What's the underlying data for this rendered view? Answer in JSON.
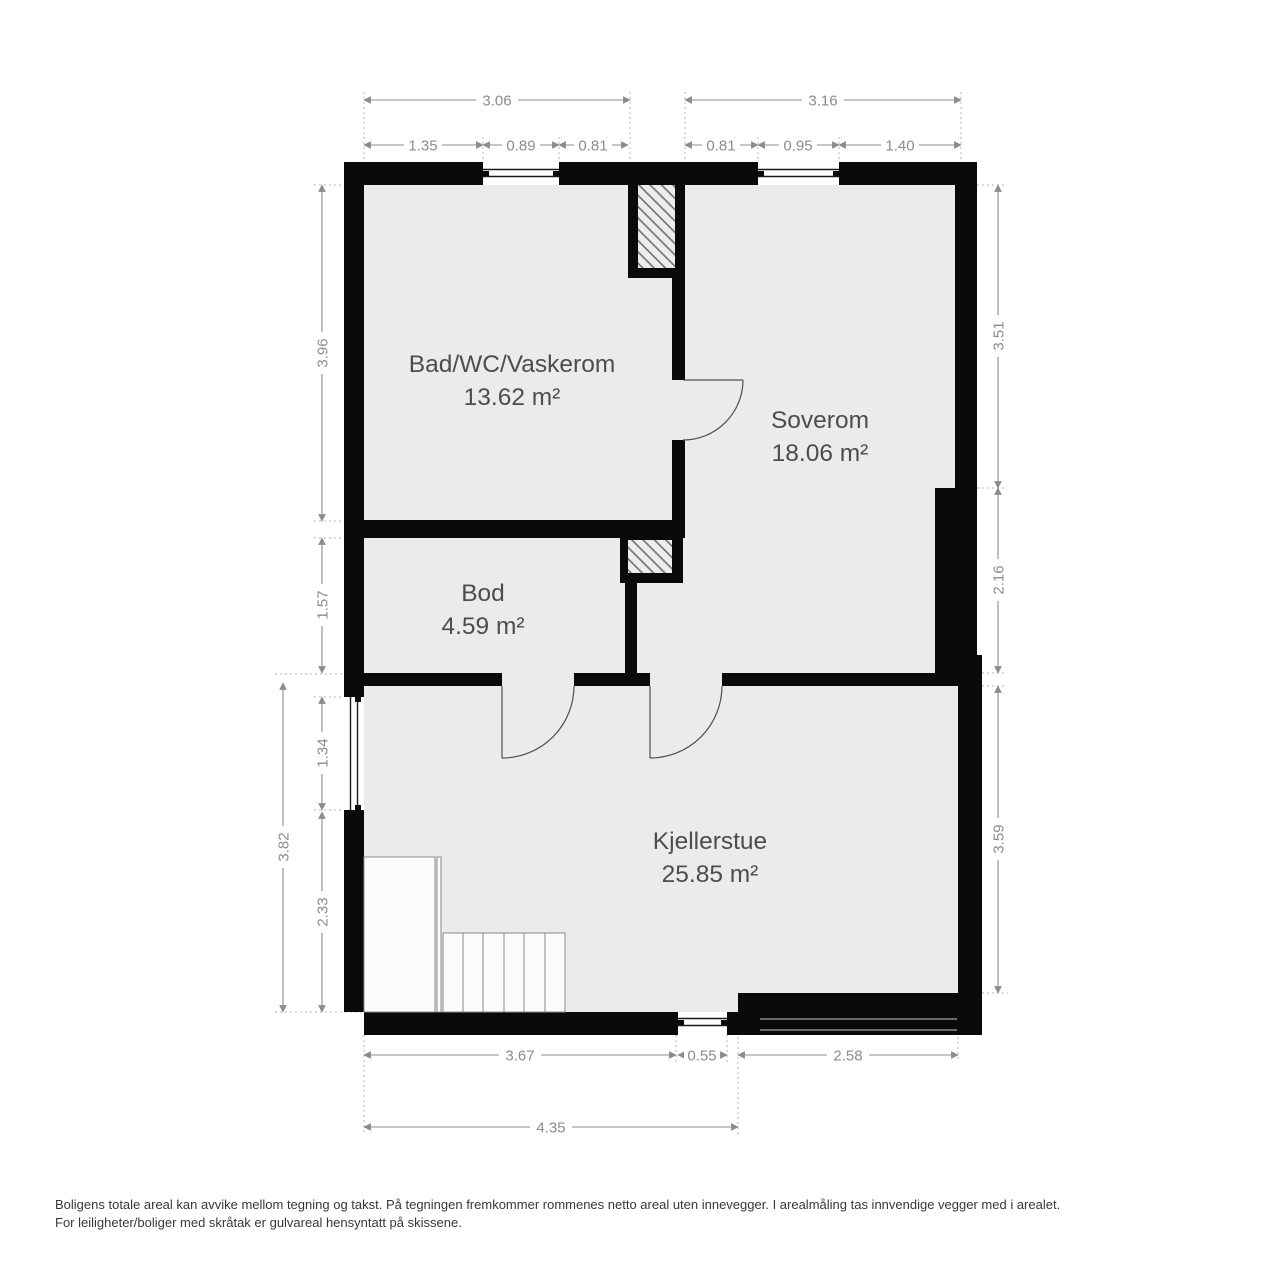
{
  "rooms": {
    "bad": {
      "name": "Bad/WC/Vaskerom",
      "area": "13.62 m²"
    },
    "soverom": {
      "name": "Soverom",
      "area": "18.06 m²"
    },
    "bod": {
      "name": "Bod",
      "area": "4.59 m²"
    },
    "kjellerstue": {
      "name": "Kjellerstue",
      "area": "25.85 m²"
    }
  },
  "dims": {
    "top_overall_left": "3.06",
    "top_overall_right": "3.16",
    "top_sub": [
      "1.35",
      "0.89",
      "0.81",
      "0.81",
      "0.95",
      "1.40"
    ],
    "left_bad": "3.96",
    "left_bod": "1.57",
    "left_overall": "3.82",
    "left_window": "1.34",
    "left_lower": "2.33",
    "right_upper": "3.51",
    "right_mid": "2.16",
    "right_lower": "3.59",
    "bottom_left": "3.67",
    "bottom_window": "0.55",
    "bottom_right": "2.58",
    "bottom_overall": "4.35"
  },
  "footer": {
    "line1": "Boligens totale areal kan avvike mellom tegning og takst. På tegningen fremkommer rommenes netto areal uten innevegger. I arealmåling tas innvendige vegger med i arealet.",
    "line2": "For leiligheter/boliger med skråtak er gulvareal hensyntatt på skissene."
  },
  "colors": {
    "wall": "#0a0a0a",
    "room_fill": "#ebebeb",
    "dimension_text": "#8c8c8c",
    "room_label": "#4d4d4d",
    "footer_text": "#383838"
  }
}
